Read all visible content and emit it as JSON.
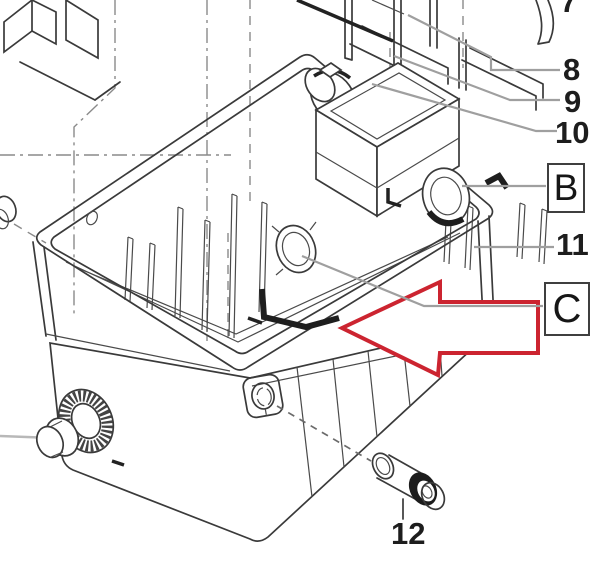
{
  "diagram": {
    "kind": "exploded-parts-line-drawing",
    "subject": "pond filter tank assembly with pump unit, clamp ring and hose fittings",
    "callouts": [
      {
        "label": "7",
        "style": "number",
        "note": "cropped at top edge"
      },
      {
        "label": "8",
        "style": "number"
      },
      {
        "label": "9",
        "style": "number"
      },
      {
        "label": "10",
        "style": "number"
      },
      {
        "label": "11",
        "style": "number"
      },
      {
        "label": "12",
        "style": "number"
      },
      {
        "label": "B",
        "style": "boxed-letter"
      },
      {
        "label": "C",
        "style": "boxed-letter"
      }
    ],
    "direction_arrow": {
      "shape": "block-arrow",
      "points": "left",
      "outline_color": "#cc2430",
      "fill": "#ffffff",
      "linked_label": "C"
    },
    "colors": {
      "background": "#ffffff",
      "drawing_line": "#3a3a3a",
      "leader_line": "#9f9f9f",
      "construction_line": "#8a8a8a",
      "label_text": "#1d1d1d",
      "arrow_red": "#cc2430"
    }
  }
}
